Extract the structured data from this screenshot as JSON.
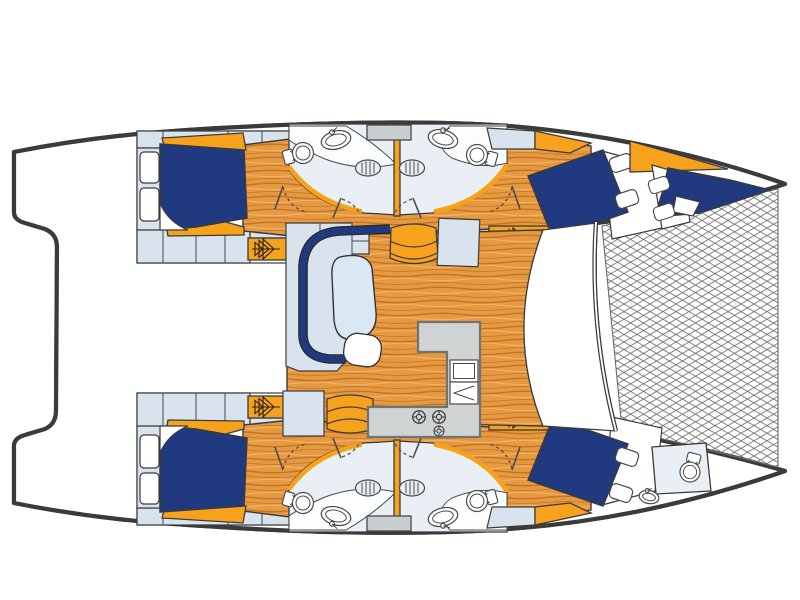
{
  "page": {
    "title": "Catamaran accommodation layout plan (overhead view)"
  },
  "palette": {
    "line": "#3b3b3b",
    "fixline": "#4a4a4a",
    "navy": "#20397f",
    "orange": "#f7a21c",
    "lblue": "#d8e3ed",
    "wood": "#e69a40",
    "wood-dark": "#c4732a",
    "wood-light": "#f2b066",
    "heads-floor": "#e9eff5",
    "galley": "#d0d3d4",
    "galley-line": "#6f7374",
    "window": "#c9ced2",
    "net-line": "#6b6b6b"
  },
  "plan": {
    "vessel_type": "sailing-catamaran",
    "view": "top-down deck and accommodation plan, bow to the right",
    "hulls": [
      {
        "name": "port-hull",
        "areas": [
          {
            "name": "aft-double-cabin",
            "features": [
              "double-berth",
              "pillow-fold",
              "shelf-lockers",
              "wardrobe-strip",
              "storage-cells"
            ]
          },
          {
            "name": "aft-head",
            "features": [
              "toilet",
              "vanity-sink",
              "floor-vent-hatch",
              "door-swing"
            ]
          },
          {
            "name": "forward-head",
            "features": [
              "toilet",
              "vanity-sink",
              "floor-vent-hatch",
              "door-swing"
            ]
          },
          {
            "name": "forward-double-cabin",
            "features": [
              "angled-double-berth",
              "pillows",
              "companionway-steps"
            ]
          },
          {
            "name": "bow-berth",
            "features": [
              "single-berth",
              "pillow",
              "foredeck-wedge"
            ]
          }
        ]
      },
      {
        "name": "starboard-hull",
        "areas": [
          {
            "name": "aft-double-cabin",
            "features": [
              "double-berth",
              "pillow-fold",
              "shelf-lockers",
              "wardrobe-strip",
              "storage-cells"
            ]
          },
          {
            "name": "aft-head",
            "features": [
              "toilet",
              "vanity-sink",
              "floor-vent-hatch",
              "door-swing"
            ]
          },
          {
            "name": "forward-head",
            "features": [
              "toilet",
              "vanity-sink",
              "floor-vent-hatch",
              "door-swing"
            ]
          },
          {
            "name": "forward-double-cabin",
            "features": [
              "angled-double-berth",
              "pillows",
              "companionway-steps"
            ]
          },
          {
            "name": "bow-head",
            "features": [
              "toilet",
              "small-sink"
            ]
          }
        ]
      }
    ],
    "bridgedeck": {
      "name": "saloon-and-galley",
      "features": [
        "c-shaped-settee",
        "saloon-table",
        "seat-pod",
        "upholstered-seat-forward",
        "upholstered-seat-aft",
        "chart-seat",
        "l-shaped-galley-counter",
        "galley-sink-unit",
        "icebox",
        "three-burner-stove",
        "forward-deck-area"
      ]
    },
    "exterior": {
      "features": [
        "bow-trampoline-net",
        "forward-crossbeam",
        "stern-platform-outline"
      ]
    },
    "counts": {
      "double-berths": 4,
      "extra-berths": 1,
      "toilets": 5,
      "sinks": 5,
      "floor-vent-hatches": 4,
      "companionway-steps": 4,
      "stove-burners": 3,
      "pillows": 6
    }
  }
}
